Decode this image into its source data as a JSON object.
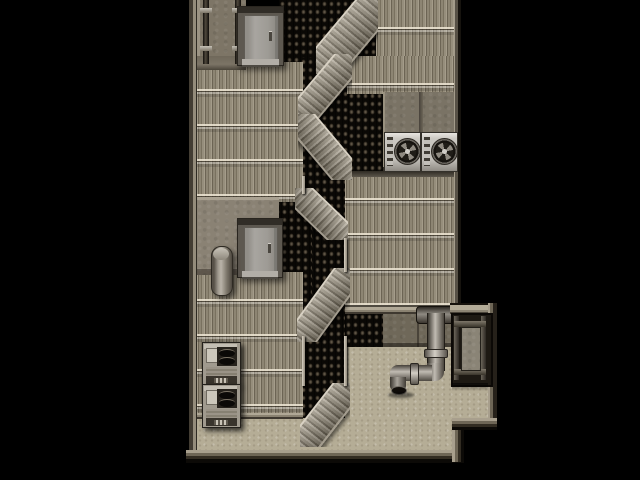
{
  "app": {
    "type": "game",
    "description": "Top-down RPG-style rooftop map: tiered corrugated roofs with switchback metal stairs, vent shafts, elevator hatches, AC fan units, compressor boxes, a drain pipe and an iron gate above a concrete courtyard, surrounded by black void",
    "viewport": {
      "width": 640,
      "height": 480
    }
  },
  "palette": {
    "void": "#000000",
    "roof_rib": "#877f6e",
    "roof_seam_light": "#eee6d4",
    "vent_black": "#0a0805",
    "vent_stud": "#6e6354",
    "concrete_platform": "#837b6c",
    "courtyard_floor": "#b5ad96",
    "stair_tread_light": "#b2aa9a",
    "railing": "#d8d1c3",
    "metal_light": "#c0bbb2",
    "metal_dark": "#3f3b34",
    "ac_body": "#cbc8c2",
    "fan_dark": "#1f1c17",
    "border_light": "#a89f8d",
    "border_dark": "#0c0a07"
  },
  "scene": {
    "areas": [
      {
        "name": "vent-shaft-top",
        "rect": [
          279,
          0,
          97,
          62
        ]
      },
      {
        "name": "vent-shaft-stair-tower",
        "rect": [
          300,
          58,
          48,
          394
        ]
      },
      {
        "name": "vent-shaft-upper-right",
        "rect": [
          348,
          92,
          37,
          80
        ]
      },
      {
        "name": "vent-shaft-mid-left",
        "rect": [
          274,
          200,
          38,
          140
        ]
      },
      {
        "name": "vent-shaft-lower-right",
        "rect": [
          345,
          313,
          40,
          34
        ]
      },
      {
        "name": "roof-left-upper",
        "rect": [
          197,
          62,
          106,
          140
        ]
      },
      {
        "name": "roof-left-lower",
        "rect": [
          197,
          272,
          106,
          146
        ]
      },
      {
        "name": "roof-right-top",
        "rect": [
          347,
          0,
          111,
          94
        ]
      },
      {
        "name": "roof-right-mid",
        "rect": [
          345,
          171,
          113,
          142
        ]
      },
      {
        "name": "pillar-top-left",
        "rect": [
          196,
          0,
          50,
          70
        ]
      },
      {
        "name": "ac-platform",
        "rect": [
          383,
          92,
          75,
          80
        ]
      },
      {
        "name": "platform-mid-left",
        "rect": [
          197,
          197,
          82,
          78
        ]
      },
      {
        "name": "wall-band-south",
        "rect": [
          383,
          313,
          75,
          34
        ]
      },
      {
        "name": "courtyard-floor-right",
        "rect": [
          345,
          347,
          143,
          73
        ]
      },
      {
        "name": "courtyard-floor-bottom",
        "rect": [
          197,
          418,
          265,
          34
        ]
      }
    ],
    "objects": [
      {
        "name": "elevator-hatch-top",
        "rect": [
          237,
          6,
          45,
          58
        ],
        "interactable": true
      },
      {
        "name": "elevator-hatch-mid",
        "rect": [
          237,
          218,
          44,
          58
        ],
        "interactable": true
      },
      {
        "name": "wall-pipes-top-left",
        "rect": [
          200,
          0,
          46,
          64
        ],
        "interactable": false
      },
      {
        "name": "duct-pipe",
        "rect": [
          211,
          246,
          20,
          48
        ],
        "interactable": false
      },
      {
        "name": "compressor-box-1",
        "rect": [
          202,
          342,
          37,
          42
        ],
        "interactable": true
      },
      {
        "name": "compressor-box-2",
        "rect": [
          202,
          384,
          37,
          42
        ],
        "interactable": true
      },
      {
        "name": "ac-fan-unit-1",
        "rect": [
          384,
          132,
          35,
          38
        ],
        "interactable": false
      },
      {
        "name": "ac-fan-unit-2",
        "rect": [
          421,
          132,
          35,
          38
        ],
        "interactable": false
      },
      {
        "name": "drain-pipe",
        "rect": [
          388,
          303,
          66,
          95
        ],
        "interactable": false
      },
      {
        "name": "iron-gate",
        "rect": [
          451,
          303,
          38,
          80
        ],
        "interactable": true
      },
      {
        "name": "stair-flight-1",
        "rect": [
          316,
          0,
          62,
          74
        ],
        "direction": "down-left",
        "interactable": true
      },
      {
        "name": "stair-flight-2",
        "rect": [
          298,
          54,
          54,
          64
        ],
        "direction": "down-left",
        "interactable": true
      },
      {
        "name": "stair-flight-3",
        "rect": [
          298,
          114,
          54,
          66
        ],
        "direction": "down-right",
        "interactable": true
      },
      {
        "name": "stair-flight-4",
        "rect": [
          295,
          188,
          53,
          52
        ],
        "direction": "down-right",
        "interactable": true
      },
      {
        "name": "stair-flight-5",
        "rect": [
          297,
          268,
          53,
          74
        ],
        "direction": "down-left",
        "interactable": true
      },
      {
        "name": "stair-flight-6",
        "rect": [
          300,
          383,
          50,
          64
        ],
        "direction": "down-left",
        "interactable": true
      }
    ]
  }
}
